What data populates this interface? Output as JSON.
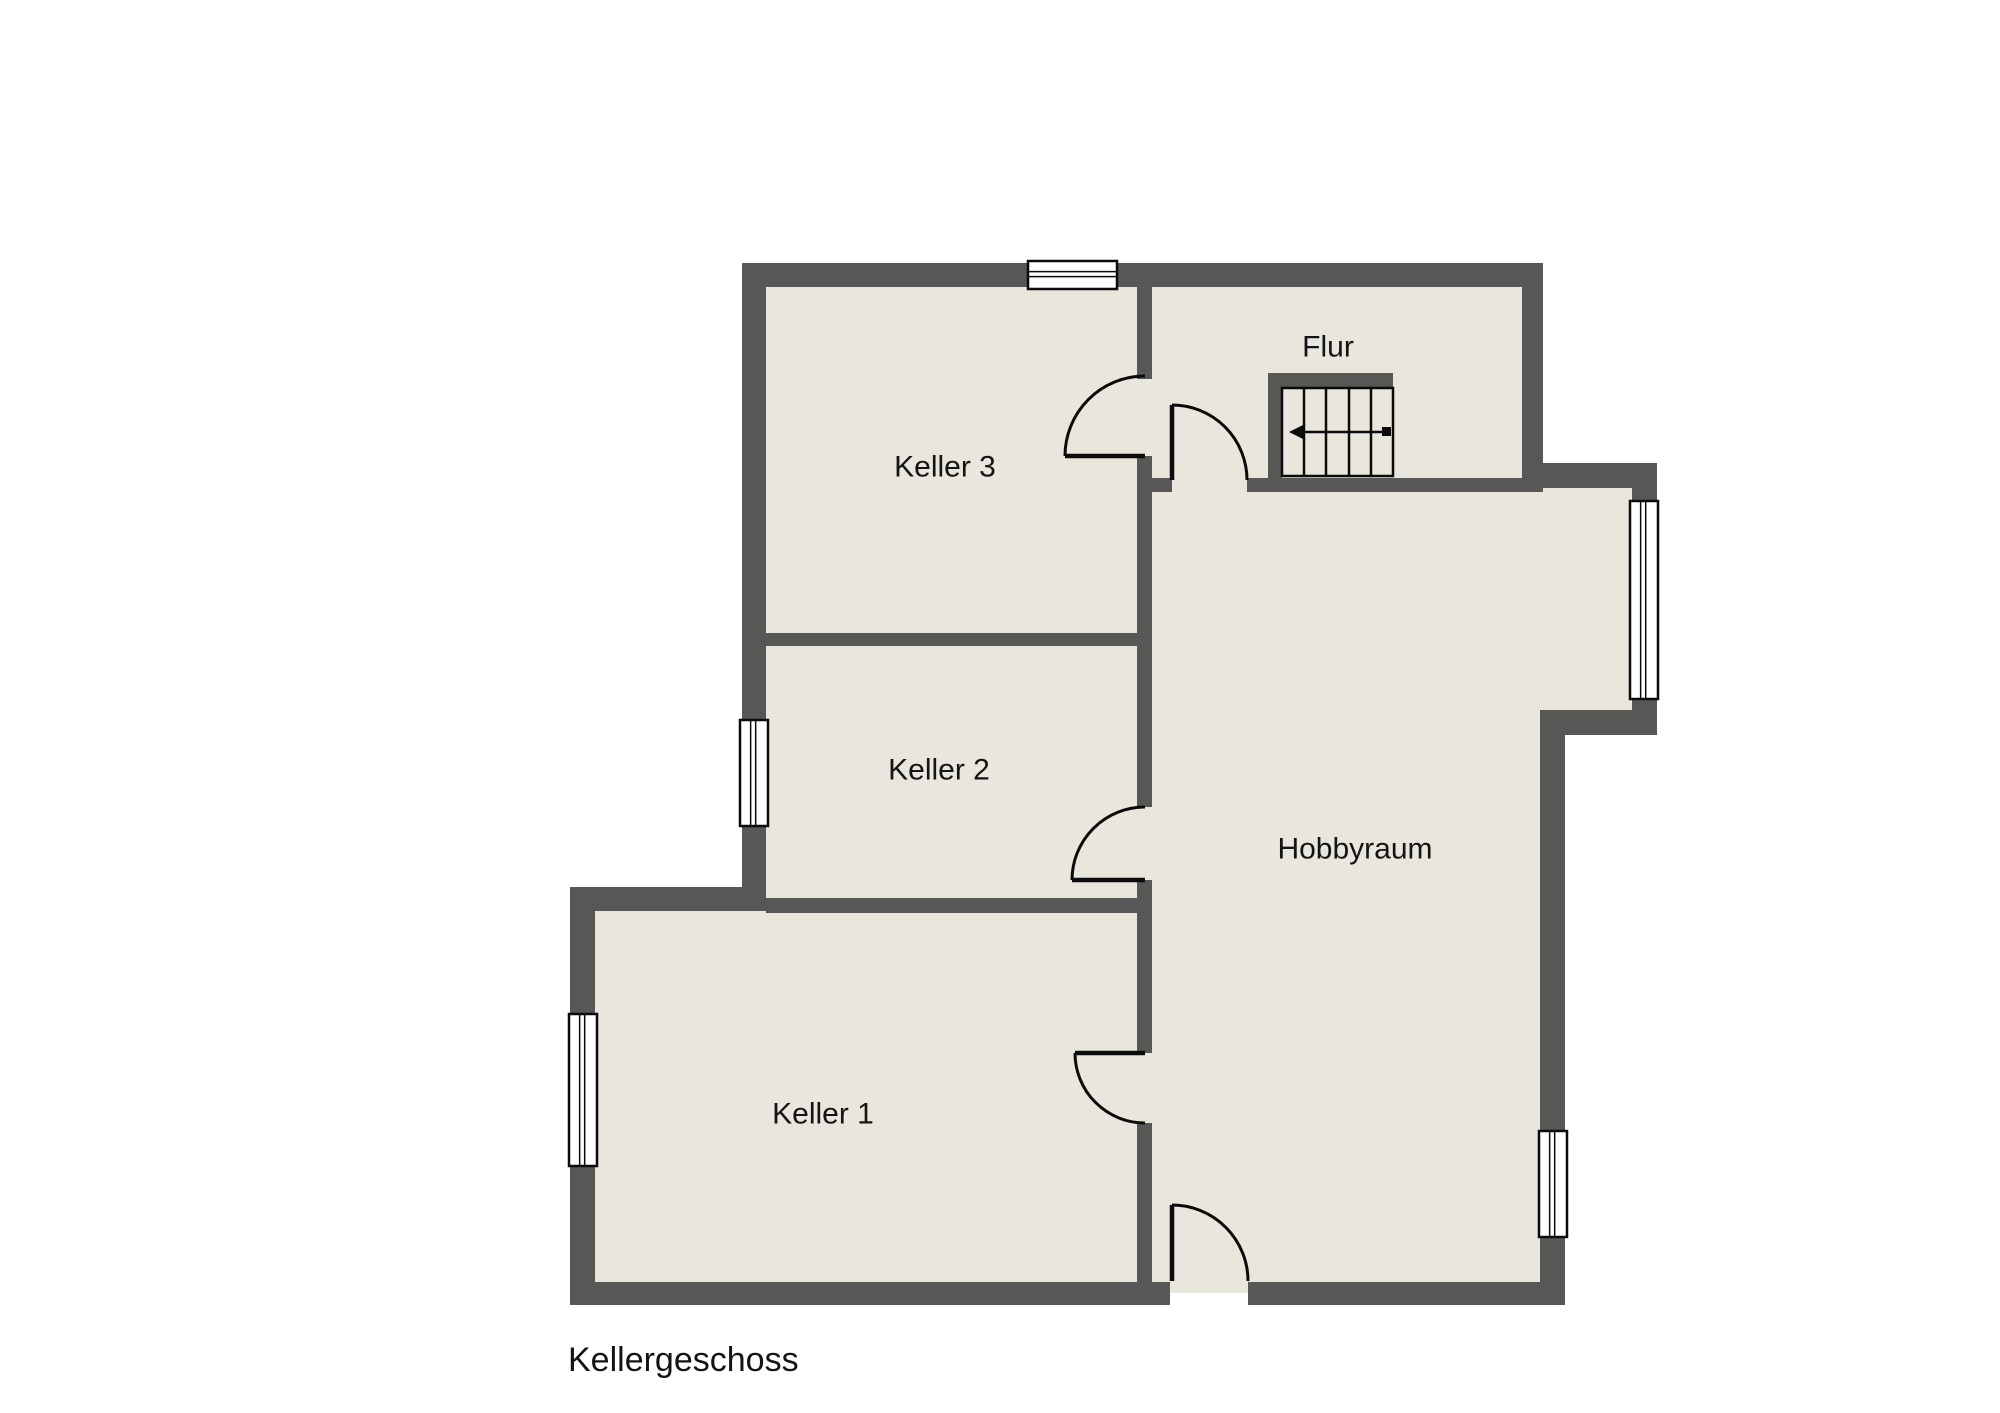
{
  "plan": {
    "title": "Kellergeschoss",
    "title_pos": {
      "x": 568,
      "y": 1371
    },
    "colors": {
      "background": "#ffffff",
      "wall": "#575756",
      "floor": "#e9e6dd",
      "line": "#0b0b0b",
      "text": "#141414"
    },
    "floors": [
      [
        754,
        275,
        778,
        209
      ],
      [
        754,
        484,
        391,
        421
      ],
      [
        583,
        899,
        562,
        394
      ],
      [
        1145,
        484,
        407,
        809
      ],
      [
        1532,
        475,
        112,
        247
      ]
    ],
    "walls": [
      [
        742,
        263,
        801,
        24
      ],
      [
        742,
        263,
        24,
        648
      ],
      [
        570,
        887,
        196,
        24
      ],
      [
        570,
        887,
        25,
        418
      ],
      [
        570,
        1282,
        600,
        23
      ],
      [
        1248,
        1282,
        317,
        23
      ],
      [
        1540,
        710,
        25,
        595
      ],
      [
        1540,
        710,
        117,
        25
      ],
      [
        1632,
        463,
        25,
        272
      ],
      [
        1543,
        463,
        114,
        25
      ],
      [
        1522,
        263,
        21,
        229
      ],
      [
        1137,
        287,
        15,
        92
      ],
      [
        1137,
        456,
        15,
        351
      ],
      [
        1137,
        880,
        15,
        173
      ],
      [
        1137,
        1123,
        15,
        159
      ],
      [
        1137,
        478,
        35,
        14
      ],
      [
        1247,
        478,
        275,
        14
      ],
      [
        766,
        633,
        371,
        13
      ],
      [
        766,
        898,
        371,
        15
      ],
      [
        1268,
        373,
        14,
        105
      ],
      [
        1268,
        373,
        125,
        15
      ]
    ],
    "windows": [
      {
        "x": 1028,
        "y": 261,
        "w": 89,
        "h": 28,
        "o": "h"
      },
      {
        "x": 740,
        "y": 720,
        "w": 28,
        "h": 106,
        "o": "v"
      },
      {
        "x": 569,
        "y": 1014,
        "w": 28,
        "h": 152,
        "o": "v"
      },
      {
        "x": 1630,
        "y": 501,
        "w": 28,
        "h": 198,
        "o": "v"
      },
      {
        "x": 1539,
        "y": 1131,
        "w": 28,
        "h": 106,
        "o": "v"
      }
    ],
    "doors": [
      {
        "name": "door-keller3",
        "arc": "M 1145,376 A 80 80 0 0 0 1065,456",
        "leaf": "M 1145,456 L 1065,456"
      },
      {
        "name": "door-flur",
        "arc": "M 1172,405 A 75 75 0 0 1 1247,480",
        "leaf": "M 1172,405 L 1172,480"
      },
      {
        "name": "door-keller2",
        "arc": "M 1145,807 A 73 73 0 0 0 1072,880",
        "leaf": "M 1145,880 L 1072,880"
      },
      {
        "name": "door-keller1",
        "arc": "M 1075,1053 A 70 70 0 0 0 1145,1123",
        "leaf": "M 1145,1053 L 1075,1053"
      },
      {
        "name": "door-exterior",
        "arc": "M 1172,1205 A 76 76 0 0 1 1248,1281",
        "leaf": "M 1172,1205 L 1172,1281"
      }
    ],
    "stairs": {
      "x": 1282,
      "y": 388,
      "w": 111,
      "h": 88,
      "treads": [
        1304,
        1326,
        1349,
        1371
      ],
      "arrow": {
        "y": 432,
        "x1": 1299,
        "x2": 1387,
        "tip": 1289,
        "sq": [
          1382,
          427,
          9,
          9
        ]
      }
    }
  },
  "rooms": [
    {
      "id": "keller3",
      "label": "Keller 3",
      "x": 945,
      "y": 467
    },
    {
      "id": "flur",
      "label": "Flur",
      "x": 1328,
      "y": 347
    },
    {
      "id": "keller2",
      "label": "Keller 2",
      "x": 939,
      "y": 770
    },
    {
      "id": "hobbyraum",
      "label": "Hobbyraum",
      "x": 1355,
      "y": 849
    },
    {
      "id": "keller1",
      "label": "Keller 1",
      "x": 823,
      "y": 1114
    }
  ]
}
